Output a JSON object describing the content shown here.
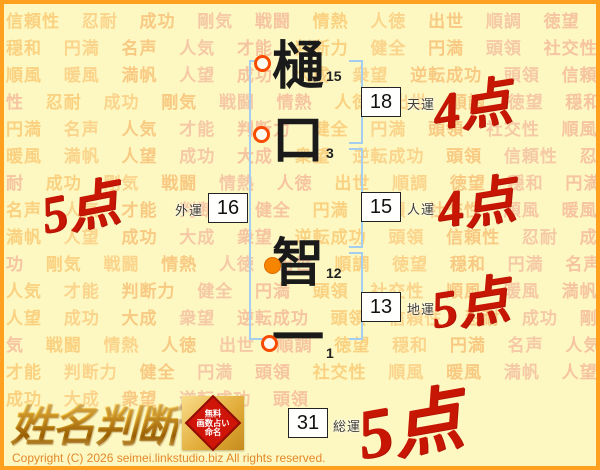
{
  "name_analysis": {
    "characters": [
      {
        "char": "樋",
        "strokes": "15",
        "marker": "ring"
      },
      {
        "char": "口",
        "strokes": "3",
        "marker": "ring"
      },
      {
        "char": "智",
        "strokes": "12",
        "marker": "dot"
      },
      {
        "char": "一",
        "strokes": "1",
        "marker": "ring"
      }
    ],
    "fortunes": [
      {
        "id": "tenun",
        "value": "18",
        "label": "天運",
        "score": "4点"
      },
      {
        "id": "gaiun",
        "value": "16",
        "label": "外運",
        "score": "5点"
      },
      {
        "id": "jinun",
        "value": "15",
        "label": "人運",
        "score": "4点"
      },
      {
        "id": "chiun",
        "value": "13",
        "label": "地運",
        "score": "5点"
      },
      {
        "id": "soun",
        "value": "31",
        "label": "総運",
        "score": "5点"
      }
    ]
  },
  "logo": {
    "title": "姓名判断",
    "seal_line1": "無料",
    "seal_line2": "画数占い",
    "seal_line3": "命名"
  },
  "footer": {
    "copyright": "Copyright (C) 2026 seimei.linkstudio.biz All rights reserved."
  },
  "background": {
    "words": [
      "信頼性",
      "忍耐",
      "成功",
      "剛気",
      "戦闘",
      "情熱",
      "人徳",
      "出世",
      "順調",
      "徳望",
      "穏和",
      "円満",
      "名声",
      "人気",
      "才能",
      "判断力",
      "健全",
      "円満",
      "頭領",
      "社交性",
      "順風",
      "暖風",
      "満帆",
      "人望",
      "成功",
      "大成",
      "衆望",
      "逆転成功",
      "頭領"
    ],
    "palette": [
      "#f9bd5e",
      "#f6b160",
      "#f3a98e",
      "#fac170",
      "#f2b096"
    ],
    "repeats": 5
  },
  "colors": {
    "page_background": "#fdf8c2",
    "page_border": "#ffa01e",
    "bracket": "#a5cdf0",
    "score_red": "#c81605",
    "marker_ring": "#f84b00",
    "marker_dot": "#f88500",
    "seal_red": "#cf1408"
  }
}
